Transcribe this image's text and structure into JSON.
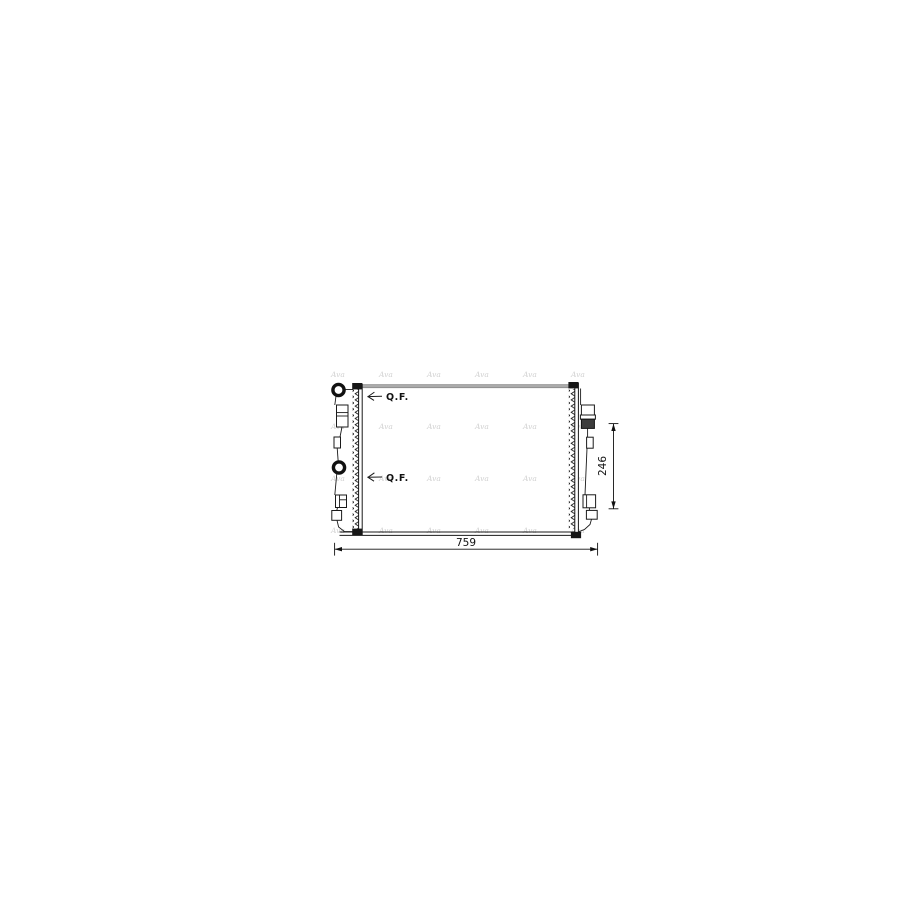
{
  "drawing": {
    "kind": "radiator-technical-drawing",
    "labels": {
      "qf_top": "Q.F.",
      "qf_bottom": "Q.F."
    },
    "dimensions": {
      "width": "759",
      "height": "246"
    },
    "watermark": {
      "text": "Ava"
    },
    "colors": {
      "line": "#1a1a1a",
      "top_edge_gray": "#ababab",
      "dark_block": "#3c3c3c",
      "watermark": "#d2d2d2",
      "background": "#ffffff"
    }
  }
}
